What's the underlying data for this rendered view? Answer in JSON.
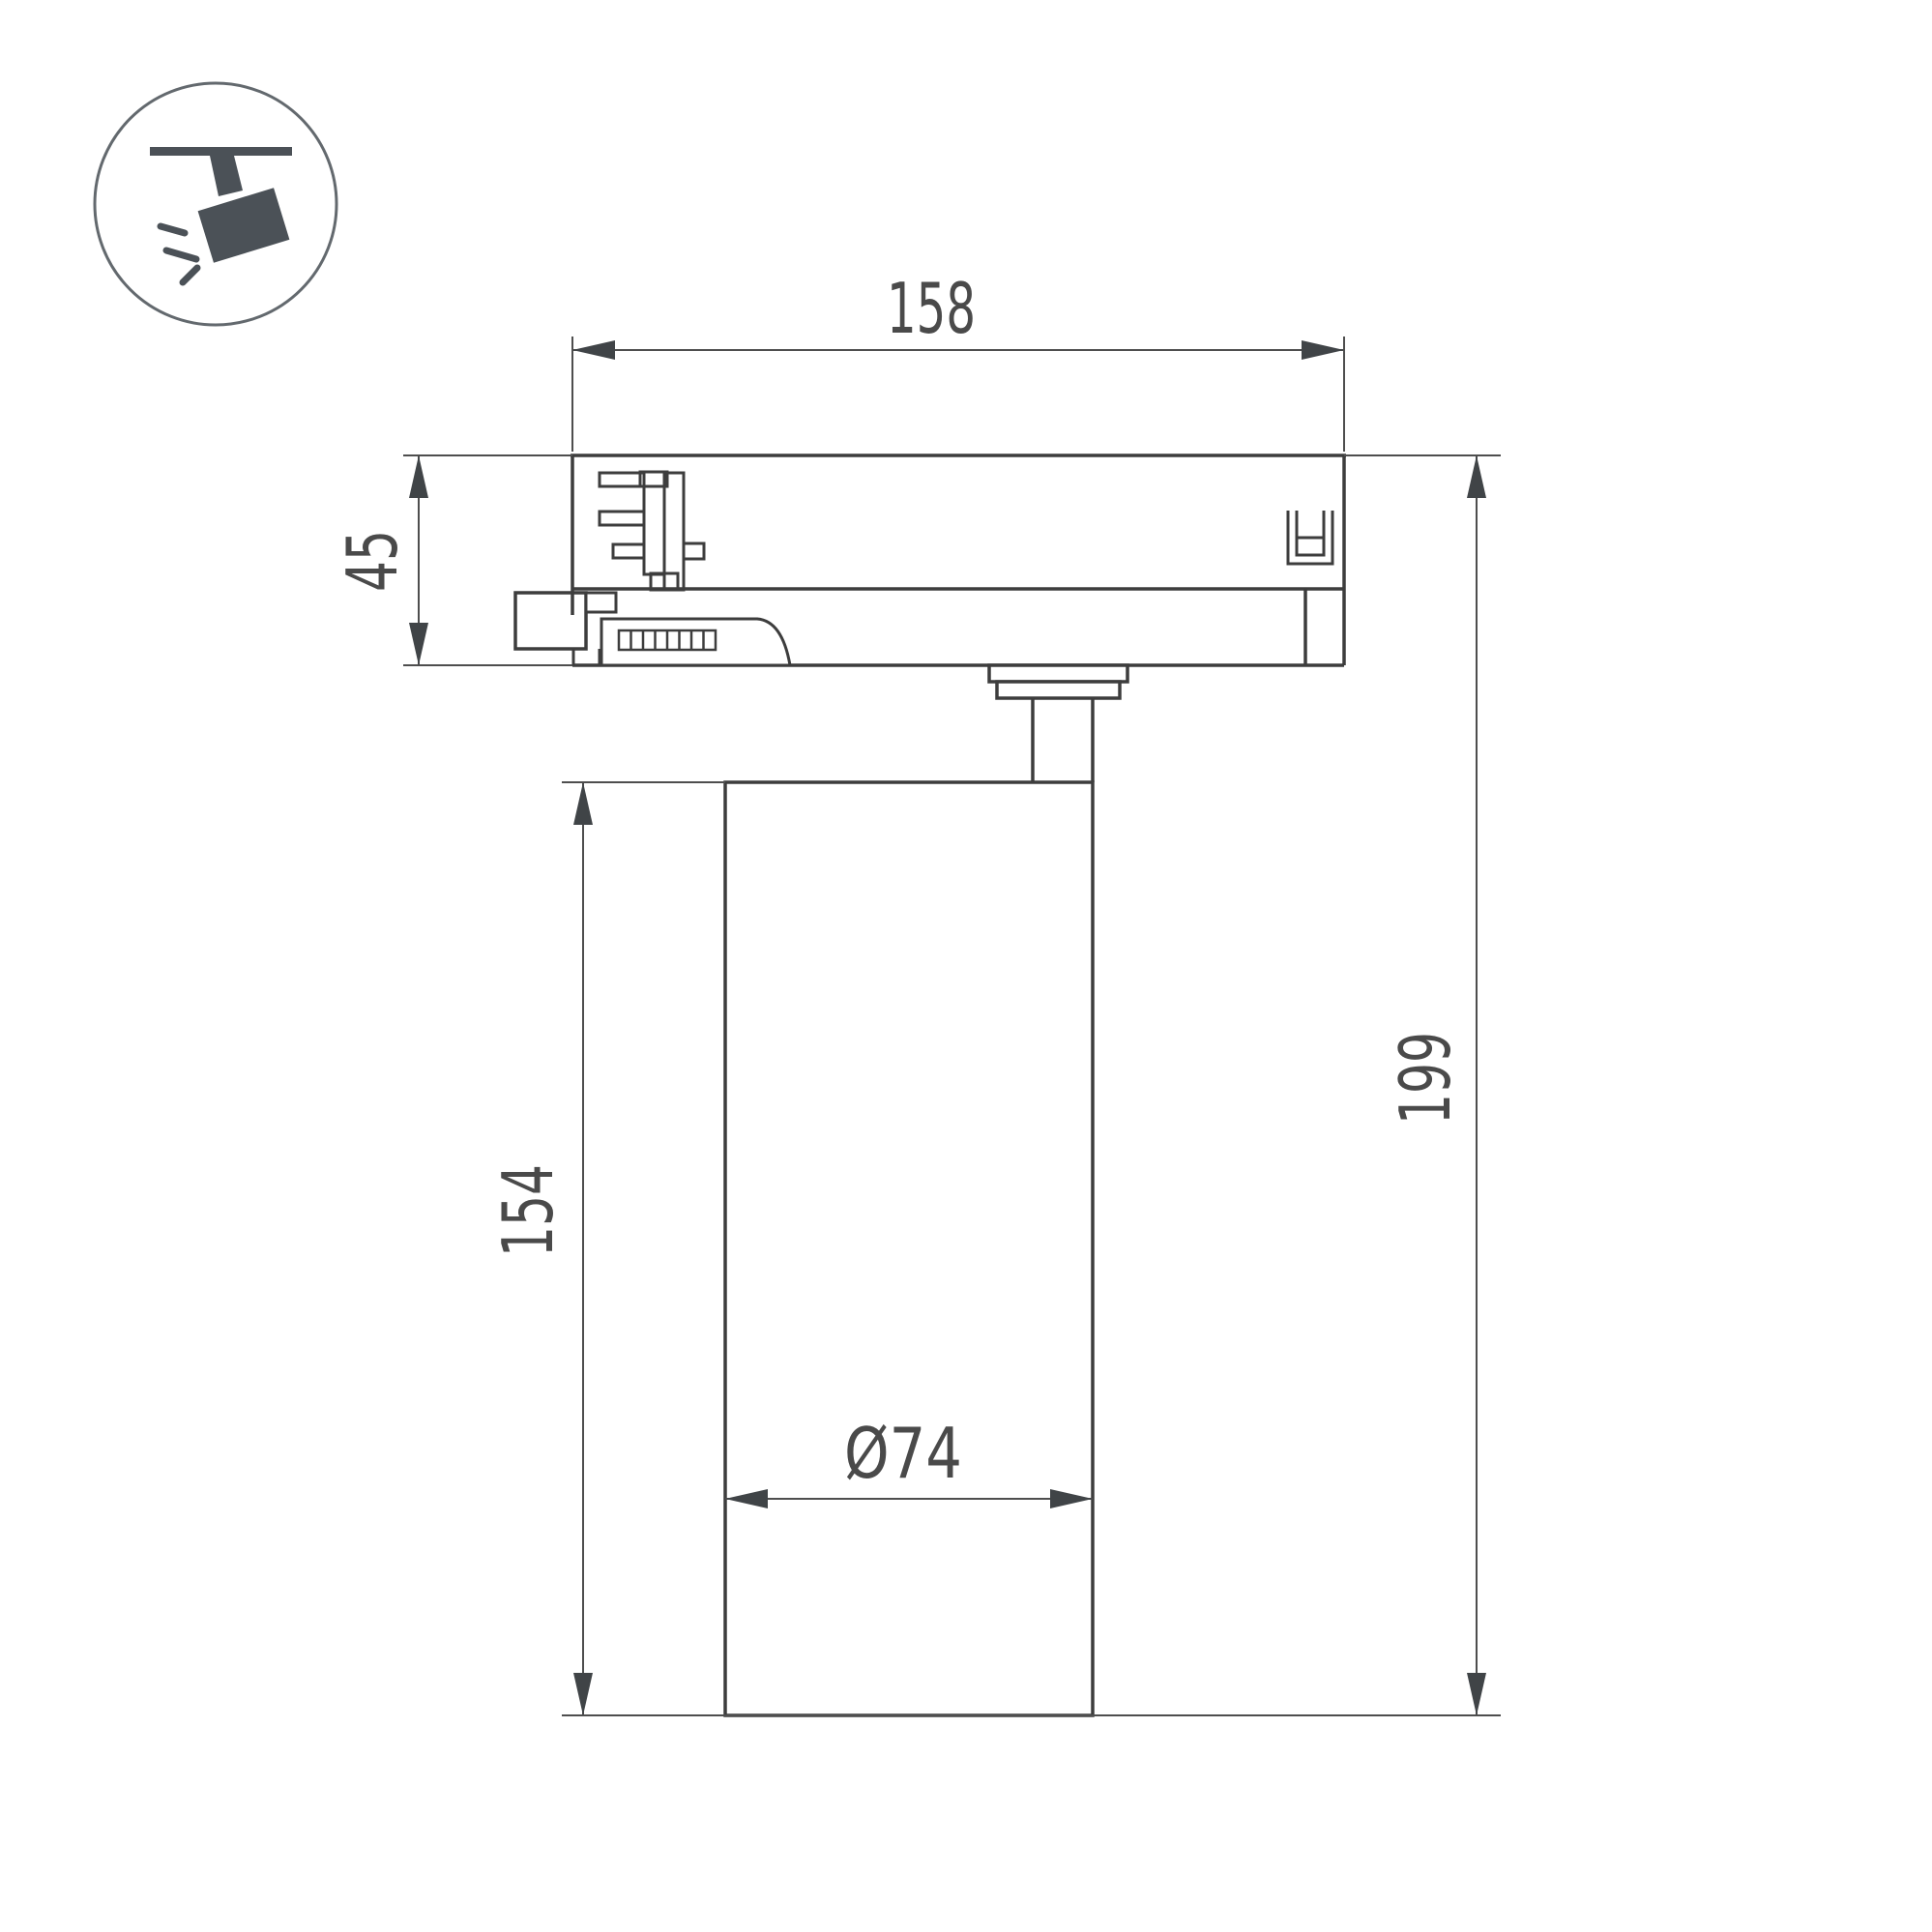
{
  "drawing": {
    "title": "track-spotlight-dimension-drawing",
    "dimensions": {
      "width_top": "158",
      "adapter_height": "45",
      "body_height": "154",
      "total_height": "199",
      "diameter": "Ø74"
    },
    "icon": {
      "name": "track-spotlight-icon",
      "color": "#4b5157",
      "ring_color": "#63696e"
    },
    "colors": {
      "background": "#ffffff",
      "outline": "#3d3d3d",
      "dimension_line": "#4e4e4e",
      "arrow": "#404447",
      "text": "#4a4a4a"
    }
  }
}
